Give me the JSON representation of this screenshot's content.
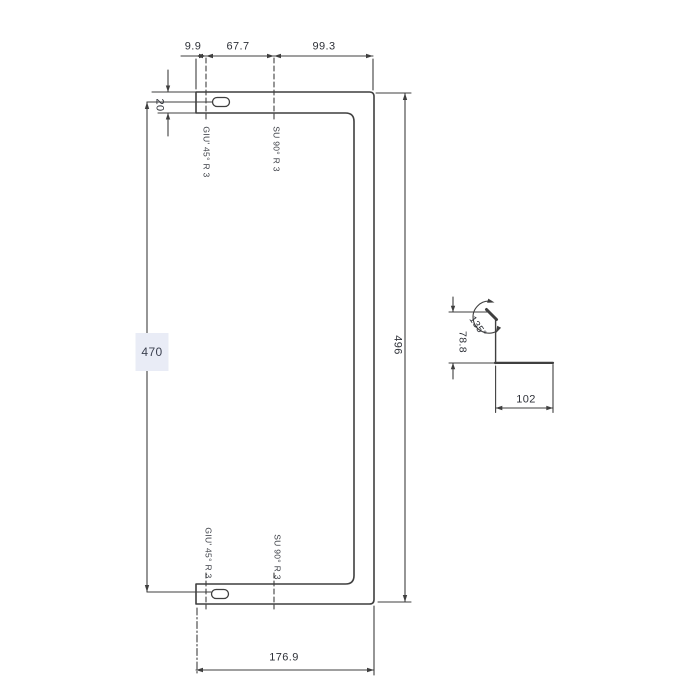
{
  "drawing": {
    "dimensions": {
      "top_left": "9.9",
      "top_mid": "67.7",
      "top_right": "99.3",
      "strip_width": "20",
      "left_height": "470",
      "right_height": "496",
      "bottom_width": "176.9"
    },
    "bend_labels": {
      "top_first": "GIU' 45° R 3",
      "top_second": "SU 90° R 3",
      "bottom_first": "GIU' 45° R 3",
      "bottom_second": "SU 90° R 3"
    },
    "detail": {
      "angle": "135°",
      "height": "78.8",
      "width": "102"
    },
    "colors": {
      "line": "#3f3f3f",
      "text": "#2e3138",
      "highlight": "#e9ecf6",
      "background": "#ffffff"
    }
  }
}
